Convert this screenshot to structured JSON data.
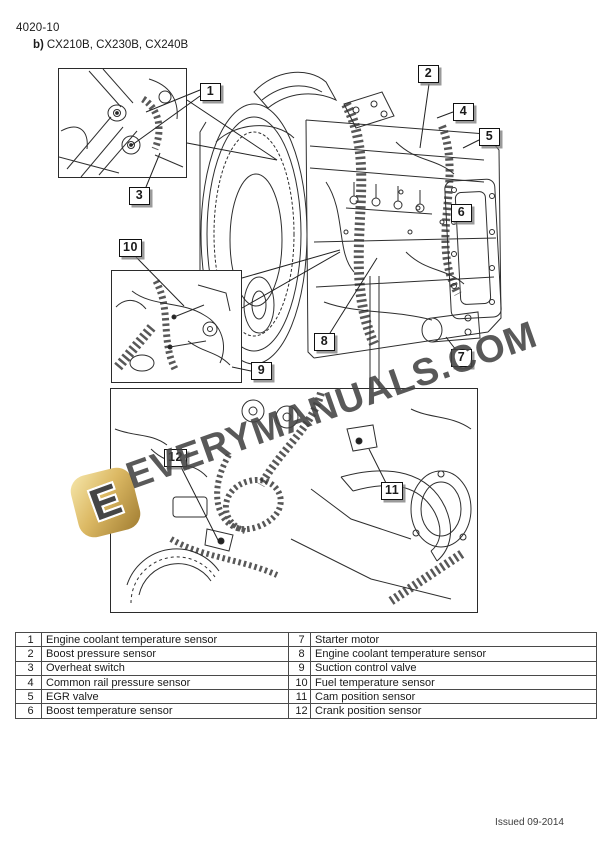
{
  "page": {
    "page_number": "4020-10",
    "section_label": "b)",
    "section_models": "CX210B, CX230B, CX240B",
    "issued": "Issued 09-2014"
  },
  "watermark": {
    "text": "EVERYMANUALS.COM",
    "logo_letter": "E",
    "logo_color_light": "#f6e7ab",
    "logo_color_dark": "#a07c31",
    "text_color": "#424242"
  },
  "callouts": [
    {
      "label": "1"
    },
    {
      "label": "2"
    },
    {
      "label": "3"
    },
    {
      "label": "4"
    },
    {
      "label": "5"
    },
    {
      "label": "6"
    },
    {
      "label": "7"
    },
    {
      "label": "8"
    },
    {
      "label": "9"
    },
    {
      "label": "10"
    },
    {
      "label": "11"
    },
    {
      "label": "12"
    }
  ],
  "legend_table": {
    "rows": [
      {
        "num_left": "1",
        "desc_left": "Engine coolant temperature sensor",
        "num_right": "7",
        "desc_right": "Starter motor"
      },
      {
        "num_left": "2",
        "desc_left": "Boost pressure sensor",
        "num_right": "8",
        "desc_right": "Engine coolant temperature sensor"
      },
      {
        "num_left": "3",
        "desc_left": "Overheat switch",
        "num_right": "9",
        "desc_right": "Suction control valve"
      },
      {
        "num_left": "4",
        "desc_left": "Common rail pressure sensor",
        "num_right": "10",
        "desc_right": "Fuel temperature sensor"
      },
      {
        "num_left": "5",
        "desc_left": "EGR valve",
        "num_right": "11",
        "desc_right": "Cam position sensor"
      },
      {
        "num_left": "6",
        "desc_left": "Boost temperature sensor",
        "num_right": "12",
        "desc_right": "Crank position sensor"
      }
    ]
  }
}
